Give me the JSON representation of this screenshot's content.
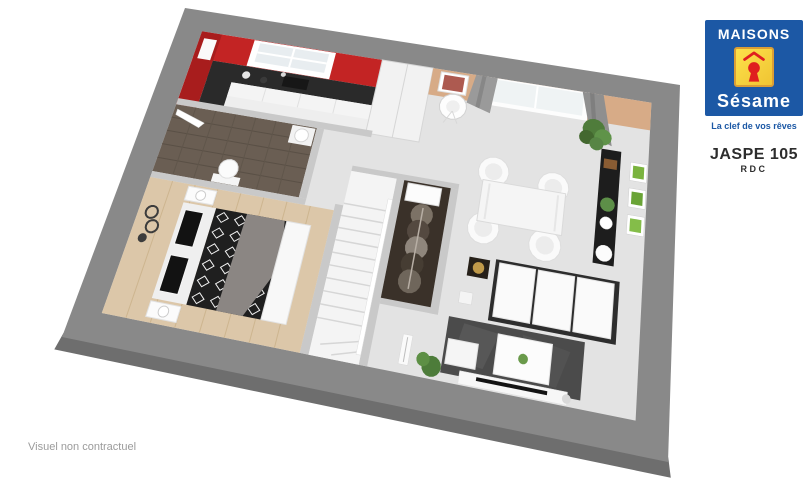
{
  "branding": {
    "name_top": "MAISONS",
    "name_script": "Sésame",
    "tagline": "La clef de vos rêves",
    "colors": {
      "blue": "#1c58a5",
      "yellow": "#f8d73a",
      "red": "#df1f1f"
    }
  },
  "plan": {
    "model": "JASPE 105",
    "level": "RDC"
  },
  "footer": {
    "note": "Visuel non contractuel"
  },
  "floorplan": {
    "view": "3d-perspective-top",
    "rooms": [
      "kitchen",
      "bathroom-entrance",
      "bedroom",
      "staircase",
      "dressing",
      "living-dining"
    ],
    "palette": {
      "slab_gray": "#898989",
      "floor_light": "#e3e3e3",
      "kitchen_red": "#c32424",
      "accent_beige": "#d7ab87",
      "wood_dark": "#6a5e53",
      "wood_light": "#dcc7a9",
      "rug_gray": "#4b4b4b"
    }
  }
}
